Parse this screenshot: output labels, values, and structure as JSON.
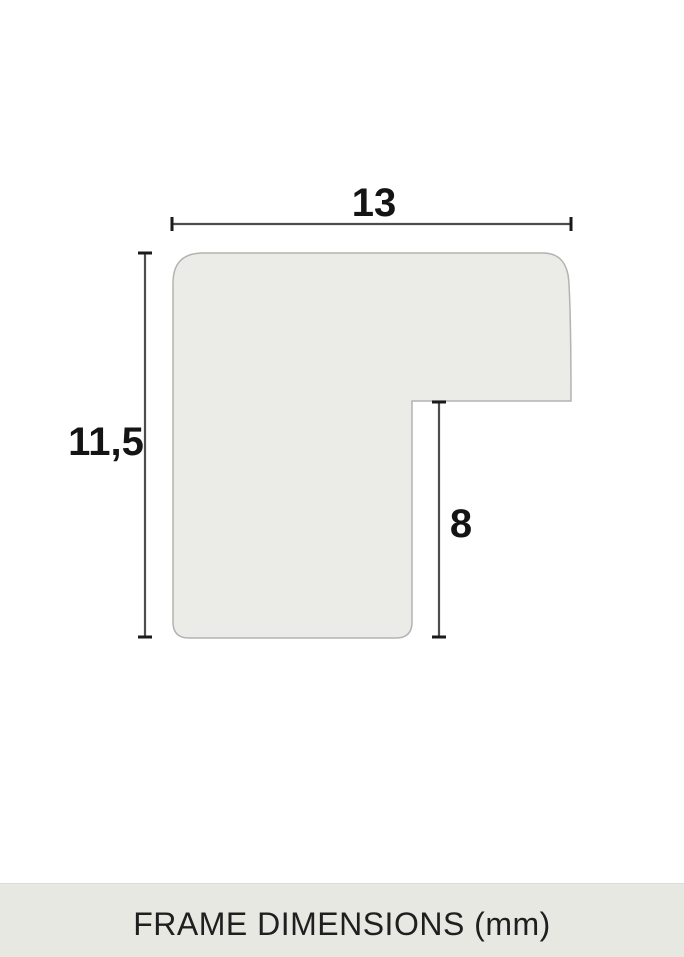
{
  "diagram": {
    "title": "frame-profile-cross-section",
    "shape_fill": "#ebebe8",
    "shape_outline": "#b3b3b0",
    "dimension_line_color": "#4d4d4d",
    "tick_color": "#1a1a1a",
    "label_color": "#141414",
    "unit": "mm",
    "dimensions": {
      "width": {
        "label": "13",
        "value_mm": 13
      },
      "height": {
        "label": "11,5",
        "value_mm": 11.5
      },
      "rabbet_depth": {
        "label": "8",
        "value_mm": 8
      }
    }
  },
  "footer": {
    "background": "#e8e8e3",
    "text": "FRAME DIMENSIONS (mm)",
    "text_color": "#1f1f1f"
  }
}
